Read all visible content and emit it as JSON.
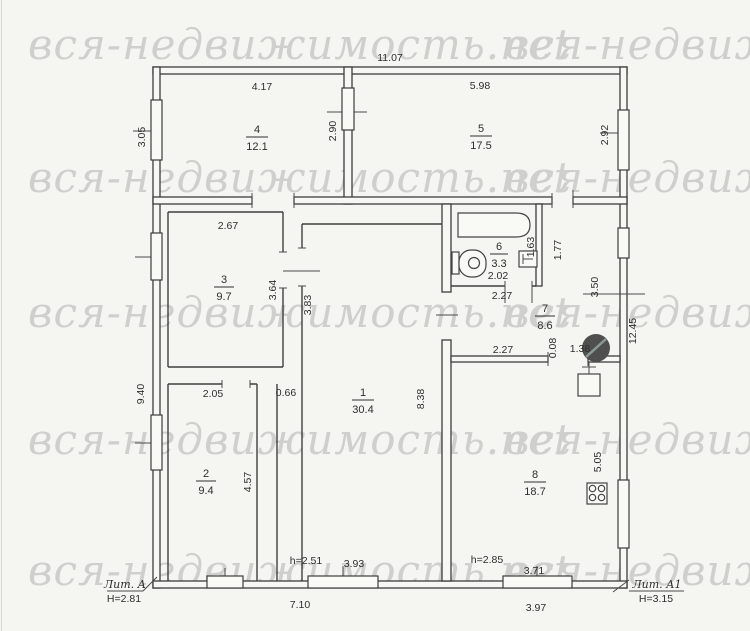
{
  "watermark": {
    "text": "вся-недвижимость.net"
  },
  "plan": {
    "rooms": [
      {
        "number": "1",
        "area": "30.4"
      },
      {
        "number": "2",
        "area": "9.4"
      },
      {
        "number": "3",
        "area": "9.7"
      },
      {
        "number": "4",
        "area": "12.1"
      },
      {
        "number": "5",
        "area": "17.5"
      },
      {
        "number": "6",
        "area": "3.3"
      },
      {
        "number": "7",
        "area": "8.6"
      },
      {
        "number": "8",
        "area": "18.7"
      }
    ],
    "dims": {
      "top_total": "11.07",
      "room4_width": "4.17",
      "room5_width": "5.98",
      "room4_left": "3.05",
      "rooms45_divider": "2.90",
      "room5_right": "2.92",
      "room3_width": "2.67",
      "room3_right": "3.64",
      "room1_left_upper": "3.83",
      "bath_width": "2.02",
      "bath_door": "2.27",
      "bath_sink": "1.63",
      "lobby_right": "1.77",
      "right_upper": "3.50",
      "right_total": "12.45",
      "room7_bottom": "2.27",
      "step": "0.08",
      "door_78": "1.38",
      "room1_right": "8.38",
      "left_total": "9.40",
      "room2_width": "2.05",
      "corridor_width": "0.66",
      "room2_right": "4.57",
      "room8_right": "5.05",
      "room1_ceiling": "h=2.51",
      "room1_window": "3.93",
      "bottom_left_total": "7.10",
      "room8_ceiling": "h=2.85",
      "room8_window": "3.71",
      "bottom_right_total": "3.97"
    },
    "annotations": {
      "lit_a": "Лит. А",
      "lit_a_h": "H=2.81",
      "lit_a1": "Лит. А1",
      "lit_a1_h": "H=3.15"
    }
  }
}
